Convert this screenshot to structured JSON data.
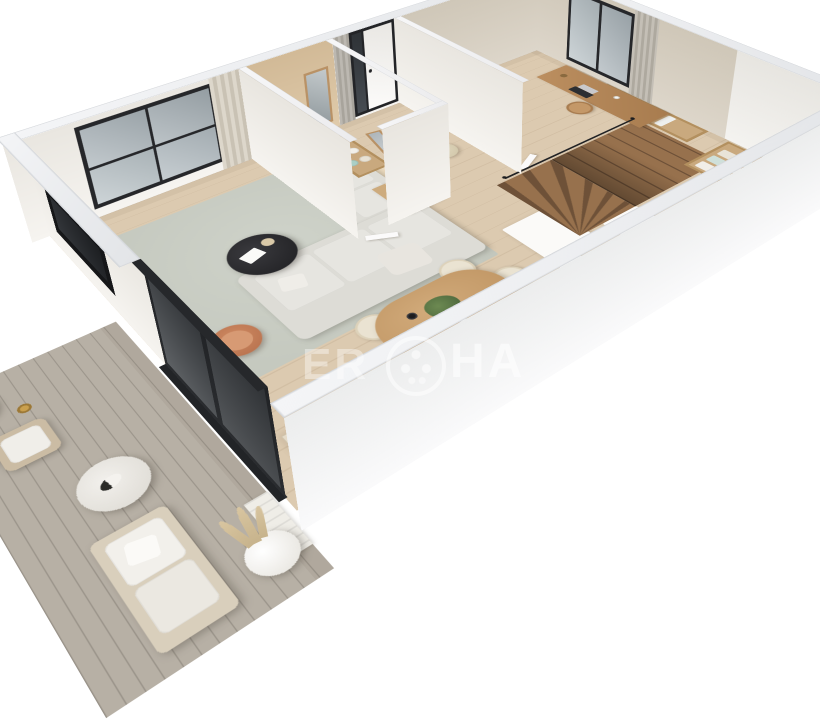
{
  "meta": {
    "description": "Photorealistic 3D isometric cutaway floor plan render of a one-bedroom apartment with terrace on a white background",
    "view": "axonometric doll-house view from south-west"
  },
  "watermark": {
    "fragment_left": "ER",
    "fragment_right": "HA",
    "logo": "circular-dotted-emblem",
    "color": "#ffffff"
  },
  "palette": {
    "background": "#ffffff",
    "wall_top": "#e9ebee",
    "wall_white_face": "#f4f2ee",
    "wall_beige_face": "#d8d1c5",
    "bathroom_wall": "#dcc6a8",
    "wood_floor": "#dccab0",
    "deck": "#b7b0a5",
    "rug": "#c9cdc4",
    "sofa": "#dddcd6",
    "armchair_terracotta": "#c07a55",
    "coffee_table_black": "#27272b",
    "wood_furniture": "#c79f6f",
    "stair_wood": "#8f6b49",
    "window_frame": "#26272a",
    "curtain_grey": "#b7b3ac",
    "curtain_beige": "#d6d0c4",
    "counter_travertine": "#e0d5c3",
    "cooktop_black": "#17181a",
    "faucet_gold": "#c9a35a",
    "plant_green": "#5a7544",
    "towel_teal": "#b7d6cf"
  },
  "rooms": {
    "living_room": {
      "name": "living room",
      "items": [
        "L-shaped light grey fabric sofa with cushions",
        "round black coffee table with white book and bowl",
        "terracotta swivel armchair",
        "grey-green area rug",
        "white TV console along wall",
        "black recessed wall TV niche",
        "large black-framed window",
        "beige curtain"
      ]
    },
    "dining_area": {
      "name": "dining area",
      "items": [
        "oval wooden dining table",
        "six cream upholstered chairs",
        "green plant centerpiece",
        "black cup",
        "white cup"
      ]
    },
    "kitchen": {
      "name": "kitchen",
      "items": [
        "travertine counter run",
        "black induction cooktop with four burners",
        "sink with gold faucet",
        "wooden cutting board",
        "white island partition"
      ]
    },
    "bathroom": {
      "name": "bathroom",
      "items": [
        "wall-hung white toilet",
        "vanity with basin and gold tap",
        "wood-framed mirror on wall",
        "open shelf with rolled towels",
        "white door ajar"
      ]
    },
    "entry_hall": {
      "name": "entry hall",
      "items": [
        "black-framed front door with white leaf",
        "leaning wood-framed mirror",
        "round beige pouf",
        "grey floor-length curtain"
      ]
    },
    "stair_hall": {
      "name": "stair hall",
      "items": [
        "wooden winder staircase to upper level",
        "black handrail",
        "white under-stair cabinet",
        "open wardrobe with hanging clothes",
        "open organizer with folded clothes",
        "vase with colourful flowers"
      ]
    },
    "office": {
      "name": "office / study",
      "items": [
        "wooden desk with laptop, lamp and mug",
        "wooden chair",
        "tall potted plant",
        "black-framed window with grey curtain",
        "white door"
      ]
    },
    "terrace": {
      "name": "terrace",
      "items": [
        "grey wood plank decking",
        "outdoor armchair with white cushions",
        "round terrazzo side table with cat",
        "outdoor sofa with white cushions",
        "pampas grass planters",
        "candle lantern",
        "black-framed sliding glass door"
      ]
    }
  }
}
